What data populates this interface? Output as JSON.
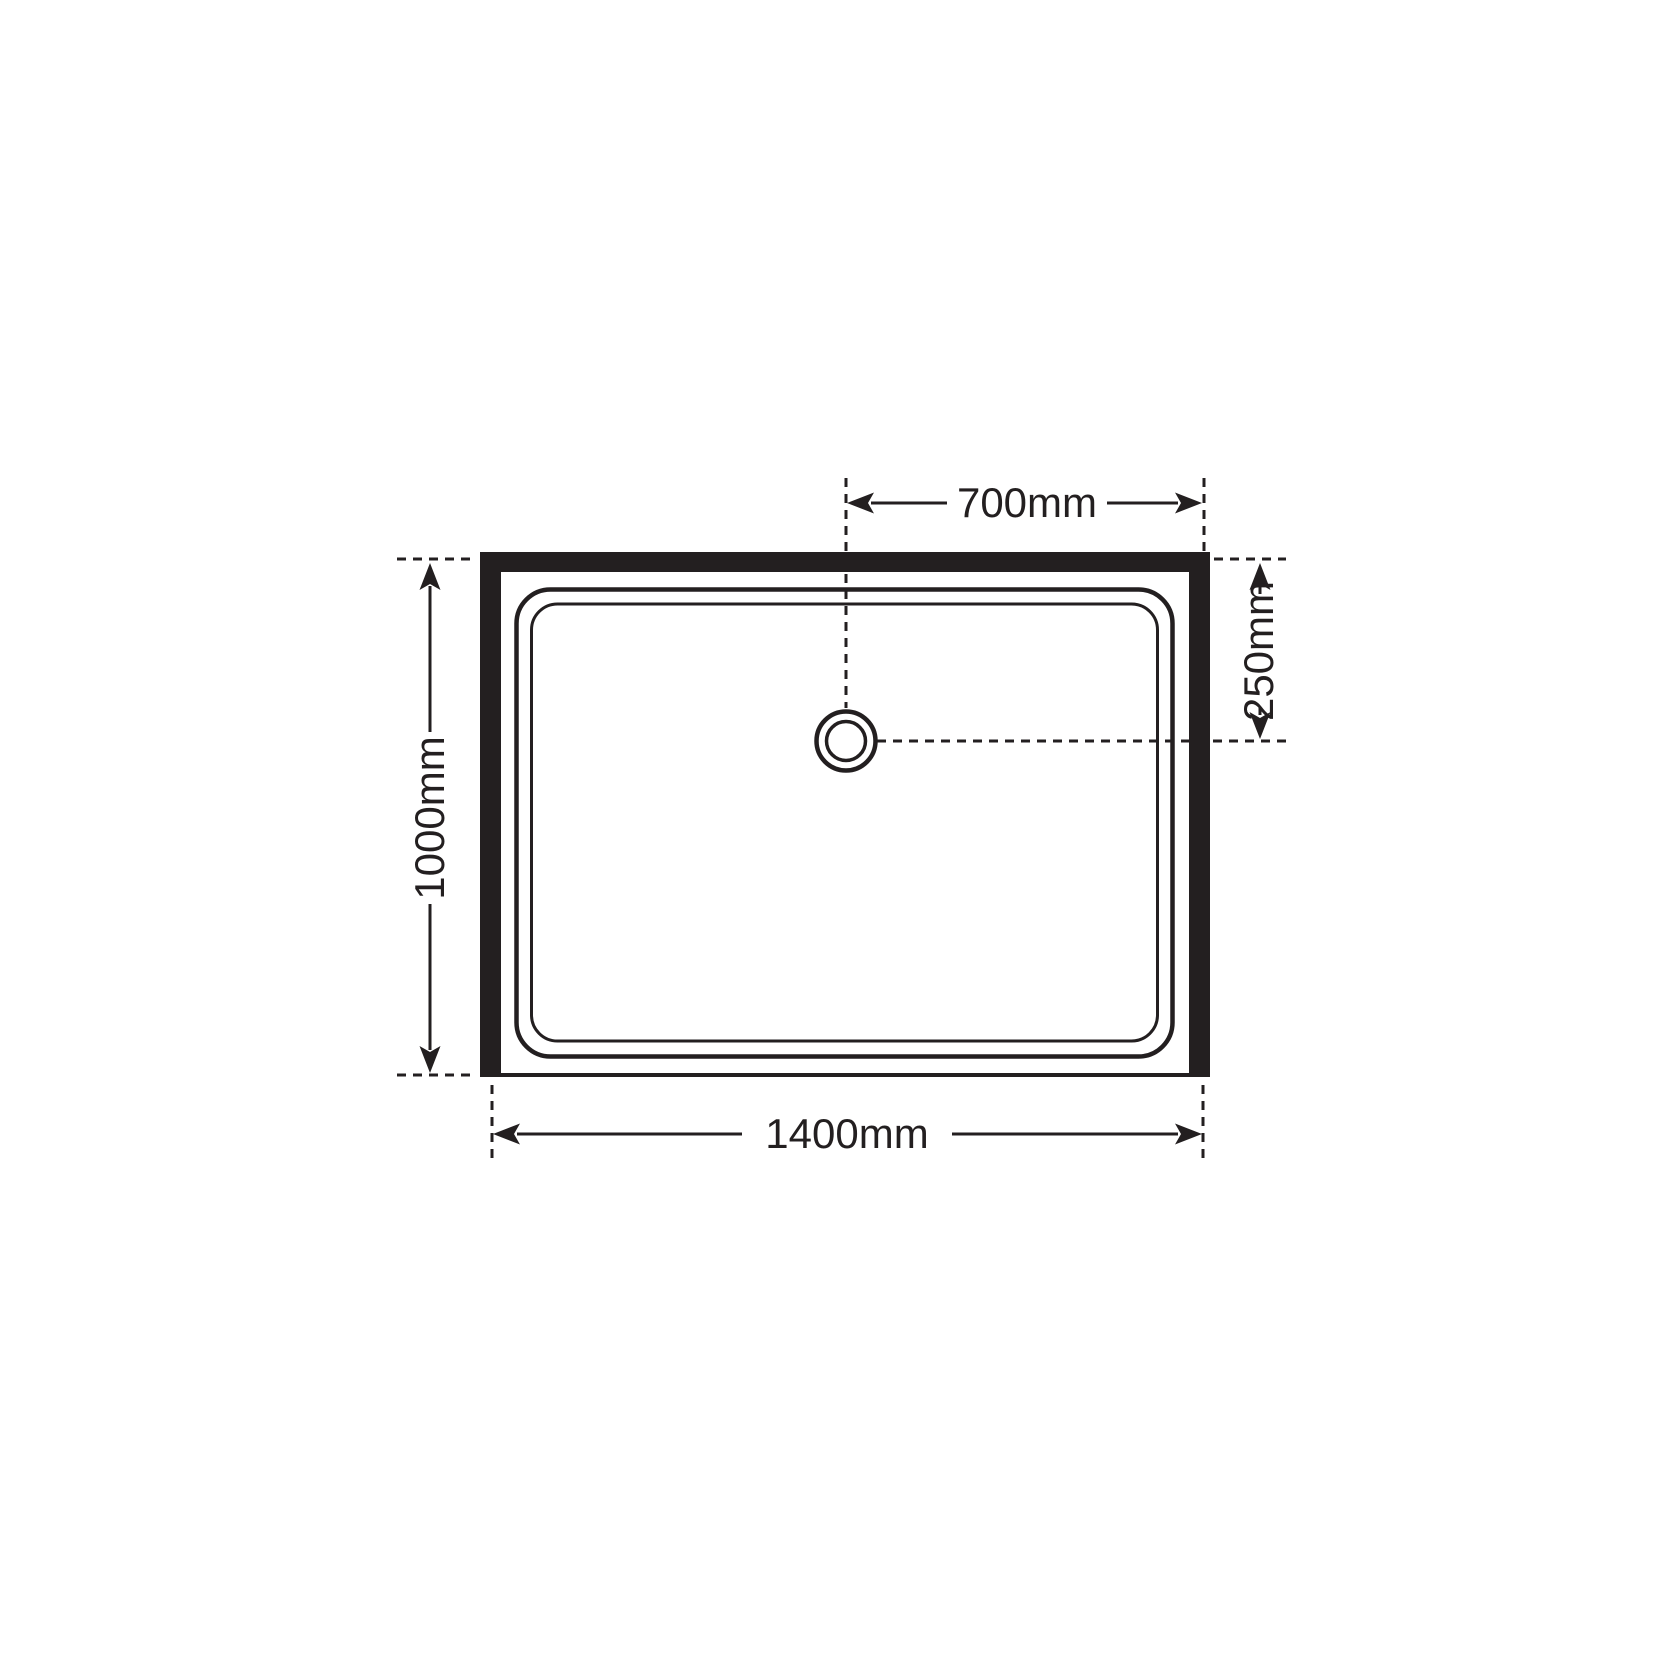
{
  "diagram": {
    "type": "technical-plan-drawing",
    "subject": "rectangular shower tray with offset drain, walls on top, left and right sides, open front edge",
    "unit": "mm",
    "colors": {
      "line": "#231f20",
      "background": "#ffffff"
    },
    "dimensions": {
      "drain_offset_horizontal": {
        "label": "700mm",
        "value": 700,
        "orientation": "horizontal",
        "position": "top"
      },
      "drain_offset_vertical": {
        "label": "250mm",
        "value": 250,
        "orientation": "vertical",
        "position": "right"
      },
      "tray_depth": {
        "label": "1000mm",
        "value": 1000,
        "orientation": "vertical",
        "position": "left"
      },
      "tray_width": {
        "label": "1400mm",
        "value": 1400,
        "orientation": "horizontal",
        "position": "bottom"
      }
    }
  }
}
